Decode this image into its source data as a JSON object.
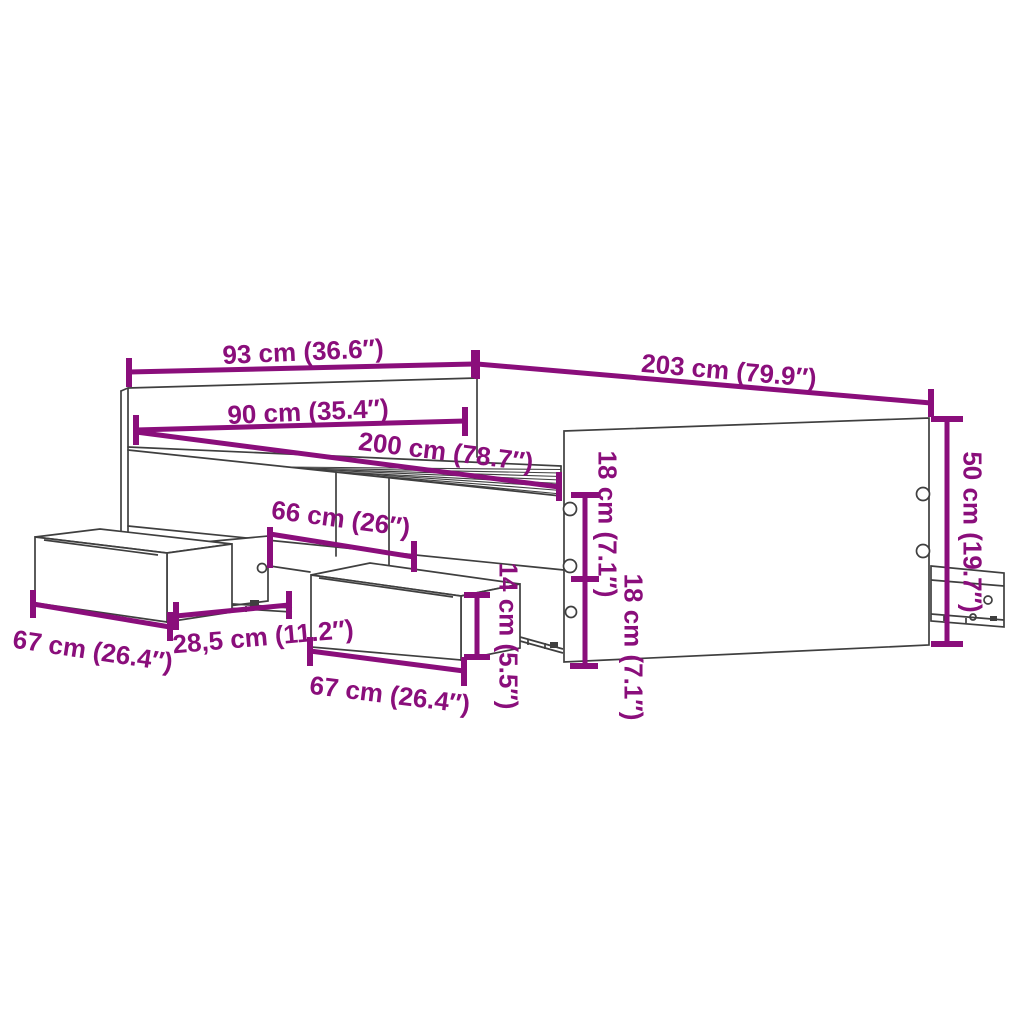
{
  "diagram": {
    "product": "Bed frame with storage drawers — dimension diagram",
    "colors": {
      "dimension": "#8A0E7B",
      "outline": "#3F3F3F",
      "background": "#FFFFFF"
    },
    "dims": {
      "headboard_width": "93 cm (36.6″)",
      "frame_length": "203 cm (79.9″)",
      "inner_width": "90 cm (35.4″)",
      "inner_length": "200 cm (78.7″)",
      "drawer_opening": "66 cm (26″)",
      "left_drawer_front": "67 cm (26.4″)",
      "runner_extension": "28,5 cm (11.2″)",
      "middle_drawer_front": "67 cm (26.4″)",
      "drawer_height": "14 cm (5.5″)",
      "rail_upper": "18 cm (7.1″)",
      "rail_lower": "18 cm (7.1″)",
      "end_height": "50 cm (19.7″)"
    }
  }
}
